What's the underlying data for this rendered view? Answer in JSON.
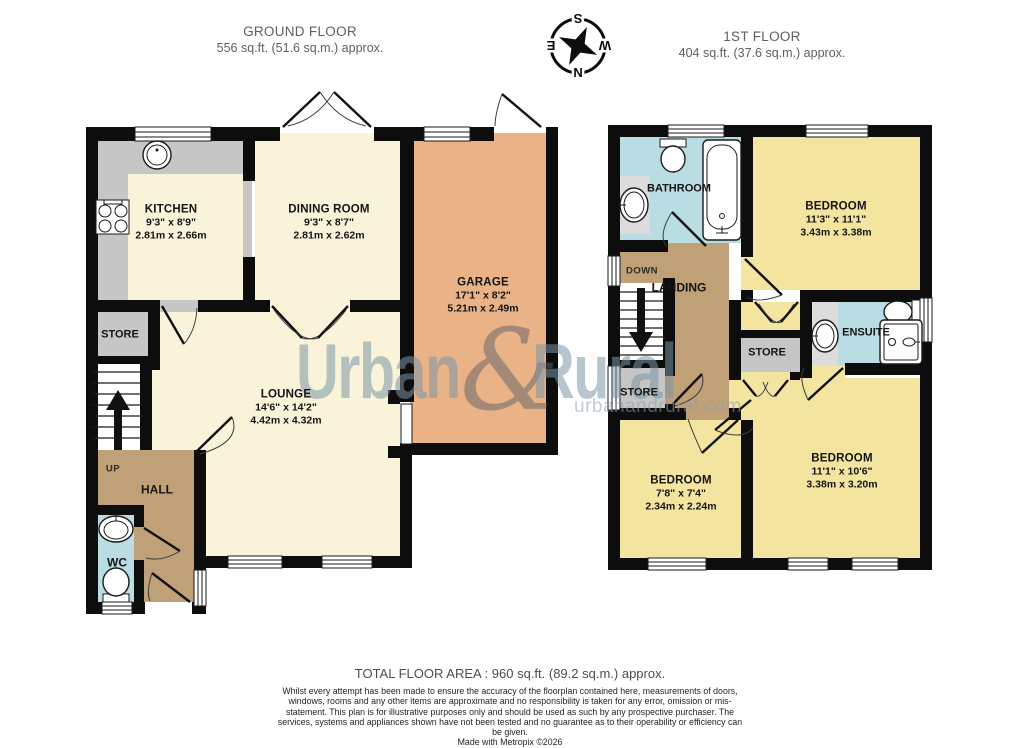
{
  "header": {
    "ground": {
      "title": "GROUND FLOOR",
      "area": "556 sq.ft. (51.6 sq.m.) approx."
    },
    "first": {
      "title": "1ST FLOOR",
      "area": "404 sq.ft. (37.6 sq.m.) approx."
    }
  },
  "compass": {
    "n": "N",
    "e": "E",
    "s": "S",
    "w": "W"
  },
  "ground_floor": {
    "kitchen": {
      "name": "KITCHEN",
      "imperial": "9'3\" x 8'9\"",
      "metric": "2.81m x 2.66m"
    },
    "dining": {
      "name": "DINING ROOM",
      "imperial": "9'3\" x 8'7\"",
      "metric": "2.81m x 2.62m"
    },
    "garage": {
      "name": "GARAGE",
      "imperial": "17'1\" x 8'2\"",
      "metric": "5.21m x 2.49m"
    },
    "lounge": {
      "name": "LOUNGE",
      "imperial": "14'6\" x 14'2\"",
      "metric": "4.42m x 4.32m"
    },
    "store": "STORE",
    "hall": "HALL",
    "wc": "WC",
    "up": "UP"
  },
  "first_floor": {
    "bathroom": "BATHROOM",
    "bedroom1": {
      "name": "BEDROOM",
      "imperial": "11'3\" x 11'1\"",
      "metric": "3.43m x 3.38m"
    },
    "bedroom2": {
      "name": "BEDROOM",
      "imperial": "7'8\" x 7'4\"",
      "metric": "2.34m x 2.24m"
    },
    "bedroom3": {
      "name": "BEDROOM",
      "imperial": "11'1\" x 10'6\"",
      "metric": "3.38m x 3.20m"
    },
    "landing": "LANDING",
    "down": "DOWN",
    "store_left": "STORE",
    "store_mid": "STORE",
    "ensuite": "ENSUITE"
  },
  "watermark": {
    "word1": "Urban",
    "amp": "&",
    "word2": "Rural",
    "site": "urbanandrural.com"
  },
  "footer": {
    "total": "TOTAL FLOOR AREA : 960 sq.ft. (89.2 sq.m.) approx.",
    "disclaimer": "Whilst every attempt has been made to ensure the accuracy of the floorplan contained here, measurements of doors, windows, rooms and any other items are approximate and no responsibility is taken for any error, omission or mis-statement. This plan is for illustrative purposes only and should be used as such by any prospective purchaser. The services, systems and appliances shown have not been tested and no guarantee as to their operability or efficiency can be given.",
    "credit": "Made with Metropix ©2026"
  },
  "colors": {
    "wall": "#0d0d0d",
    "cream": "#f9f3da",
    "garage": "#e9b287",
    "bedroom": "#f3e5a0",
    "wet": "#b9dde3",
    "hall": "#c0a077",
    "store": "#c6c6c6"
  }
}
